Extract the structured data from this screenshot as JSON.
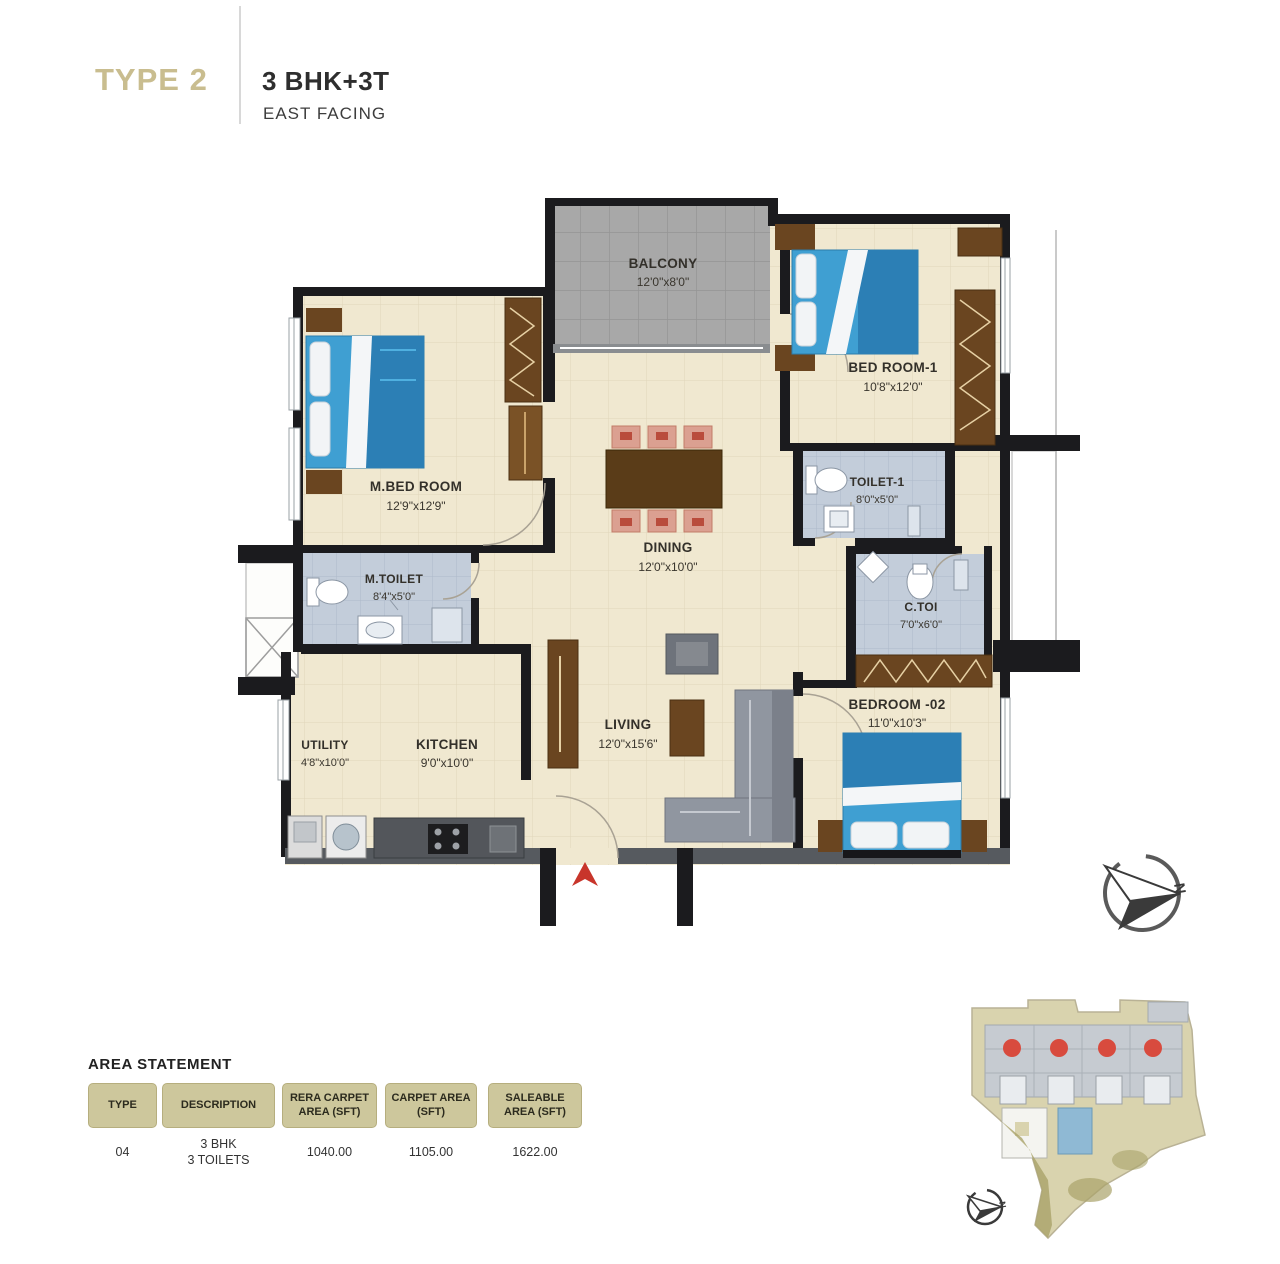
{
  "header": {
    "type_label": "TYPE 2",
    "title": "3 BHK+3T",
    "subtitle": "EAST FACING"
  },
  "rooms": {
    "balcony": {
      "name": "BALCONY",
      "dims": "12'0\"x8'0\""
    },
    "bedroom1": {
      "name": "BED ROOM-1",
      "dims": "10'8\"x12'0\""
    },
    "mbedroom": {
      "name": "M.BED ROOM",
      "dims": "12'9\"x12'9\""
    },
    "toilet1": {
      "name": "TOILET-1",
      "dims": "8'0\"x5'0\""
    },
    "ctoi": {
      "name": "C.TOI",
      "dims": "7'0\"x6'0\""
    },
    "dining": {
      "name": "DINING",
      "dims": "12'0\"x10'0\""
    },
    "mtoilet": {
      "name": "M.TOILET",
      "dims": "8'4\"x5'0\""
    },
    "utility": {
      "name": "UTILITY",
      "dims": "4'8\"x10'0\""
    },
    "kitchen": {
      "name": "KITCHEN",
      "dims": "9'0\"x10'0\""
    },
    "living": {
      "name": "LIVING",
      "dims": "12'0\"x15'6\""
    },
    "bedroom2": {
      "name": "BEDROOM -02",
      "dims": "11'0\"x10'3\""
    }
  },
  "compass": {
    "north_label": "N"
  },
  "area_statement": {
    "title": "AREA STATEMENT",
    "columns": [
      "TYPE",
      "DESCRIPTION",
      "RERA CARPET AREA (SFT)",
      "CARPET AREA (SFT)",
      "SALEABLE AREA (SFT)"
    ],
    "row": {
      "type": "04",
      "description": "3 BHK\n3 TOILETS",
      "rera_carpet": "1040.00",
      "carpet": "1105.00",
      "saleable": "1622.00"
    }
  },
  "colors": {
    "accent_gold": "#c9bd8f",
    "table_header_bg": "#cdc79c",
    "wall": "#1b1b1e",
    "floor": "#f0e8d0",
    "toilet_floor": "#c3cdda",
    "balcony_floor": "#a8a8a8",
    "bed_blue": "#3f9fd2",
    "furniture_brown": "#6a4520",
    "entry_arrow_red": "#c8352b"
  }
}
